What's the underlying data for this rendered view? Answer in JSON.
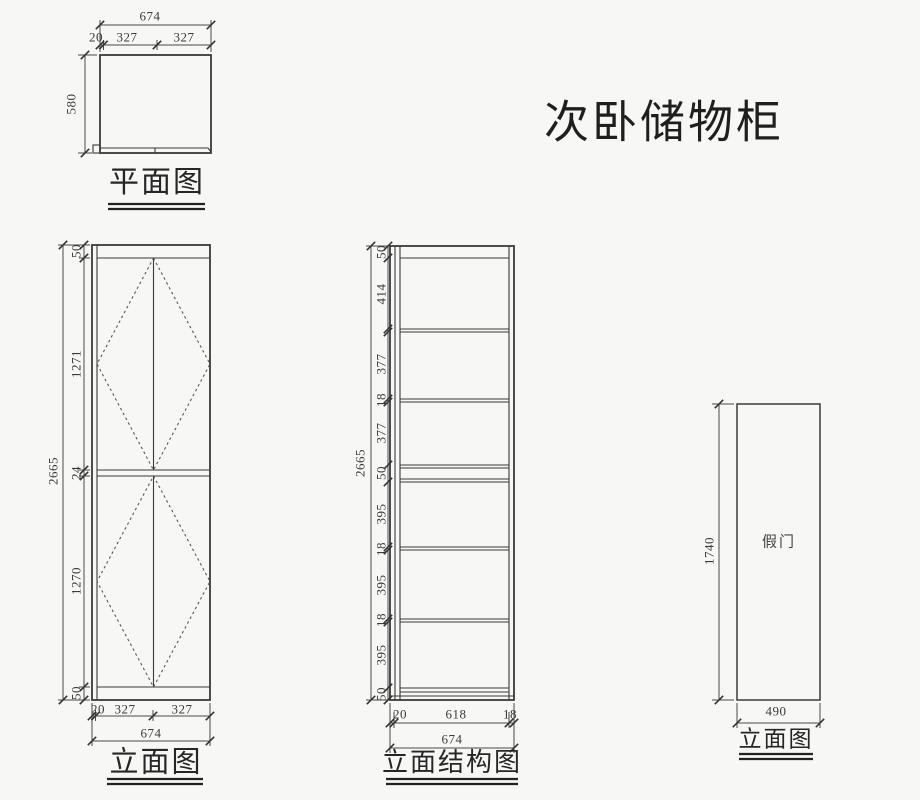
{
  "title": "次卧储物柜",
  "plan_view": {
    "label": "平面图",
    "width_total": "674",
    "width_splits": [
      "20",
      "327",
      "327"
    ],
    "depth": "580"
  },
  "front_elevation": {
    "label": "立面图",
    "height_total": "2665",
    "height_segments": [
      "50",
      "1271",
      "24",
      "1270",
      "50"
    ],
    "width_splits": [
      "20",
      "327",
      "327"
    ],
    "width_total": "674"
  },
  "structure_elevation": {
    "label": "立面结构图",
    "height_total": "2665",
    "height_segments": [
      "50",
      "414",
      "377",
      "18",
      "377",
      "50",
      "395",
      "18",
      "395",
      "18",
      "395",
      "50"
    ],
    "width_splits": [
      "20",
      "618",
      "18"
    ],
    "width_total": "674"
  },
  "side_elevation": {
    "label": "立面图",
    "door_text": "假门",
    "height": "1740",
    "width": "490"
  }
}
